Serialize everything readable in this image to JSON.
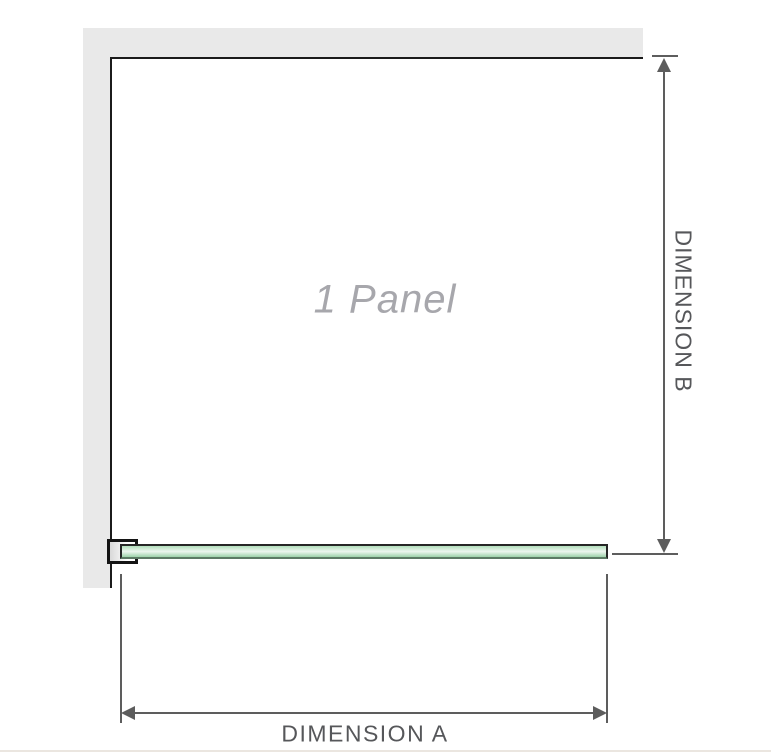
{
  "figure": {
    "panel_label": "1 Panel",
    "dimensions": {
      "a_label": "DIMENSION A",
      "b_label": "DIMENSION B"
    },
    "colors": {
      "wall_gray": "#e9e9e9",
      "frame_black": "#1b1b1b",
      "dimension_line_gray": "#5d5d5d",
      "dimension_text_gray": "#56575a",
      "panel_label_gray": "#a7a7ac",
      "glass_green": "#9cd2a9",
      "glass_green_light": "#edf6ef",
      "glass_border": "#262626",
      "bottom_divider": "#ebe6e0"
    }
  }
}
